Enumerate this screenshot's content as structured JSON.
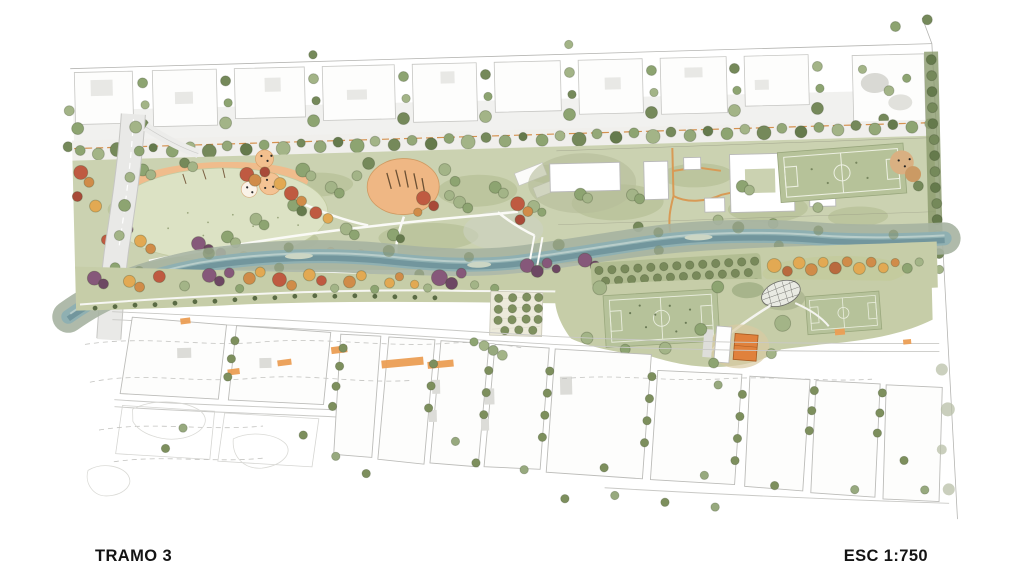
{
  "titleblock": {
    "section_label": "TRAMO 3",
    "scale_label": "ESC 1:750"
  },
  "plan": {
    "type": "landscape-architecture-masterplan",
    "features": [
      "north-city-blocks",
      "tree-lined-avenue",
      "west-road-bridge",
      "great-lawn",
      "orange-event-plazas",
      "hatched-orange-plaza",
      "linear-river-park",
      "river-channel",
      "pedestrian-bridge",
      "park-buildings",
      "north-soccer-field",
      "riverside-tree-rows",
      "orchard-tree-grid",
      "yellow-grove",
      "south-soccer-fields",
      "domed-pavilion",
      "orange-building",
      "tree-grid-plaza",
      "south-street-grid",
      "orange-pedestrian-route",
      "contour-lines",
      "plan-boundary"
    ],
    "palette": {
      "background": "#ffffff",
      "park_green": "#cbd2b1",
      "lawn_green": "#dce2c4",
      "water": "#8fb0b2",
      "water_deep": "#6f949a",
      "river_bank": "#a6b2a1",
      "tree_green": "#8da471",
      "tree_dark_green": "#75895a",
      "tree_sage": "#a3b487",
      "tree_orange": "#e2a953",
      "tree_red": "#bf5a41",
      "tree_purple": "#86587a",
      "plaza_orange": "#efb784",
      "building_orange": "#e0813c",
      "pitch_green": "#b6c29a",
      "street_line": "#c6c6c3",
      "text": "#141414"
    }
  }
}
